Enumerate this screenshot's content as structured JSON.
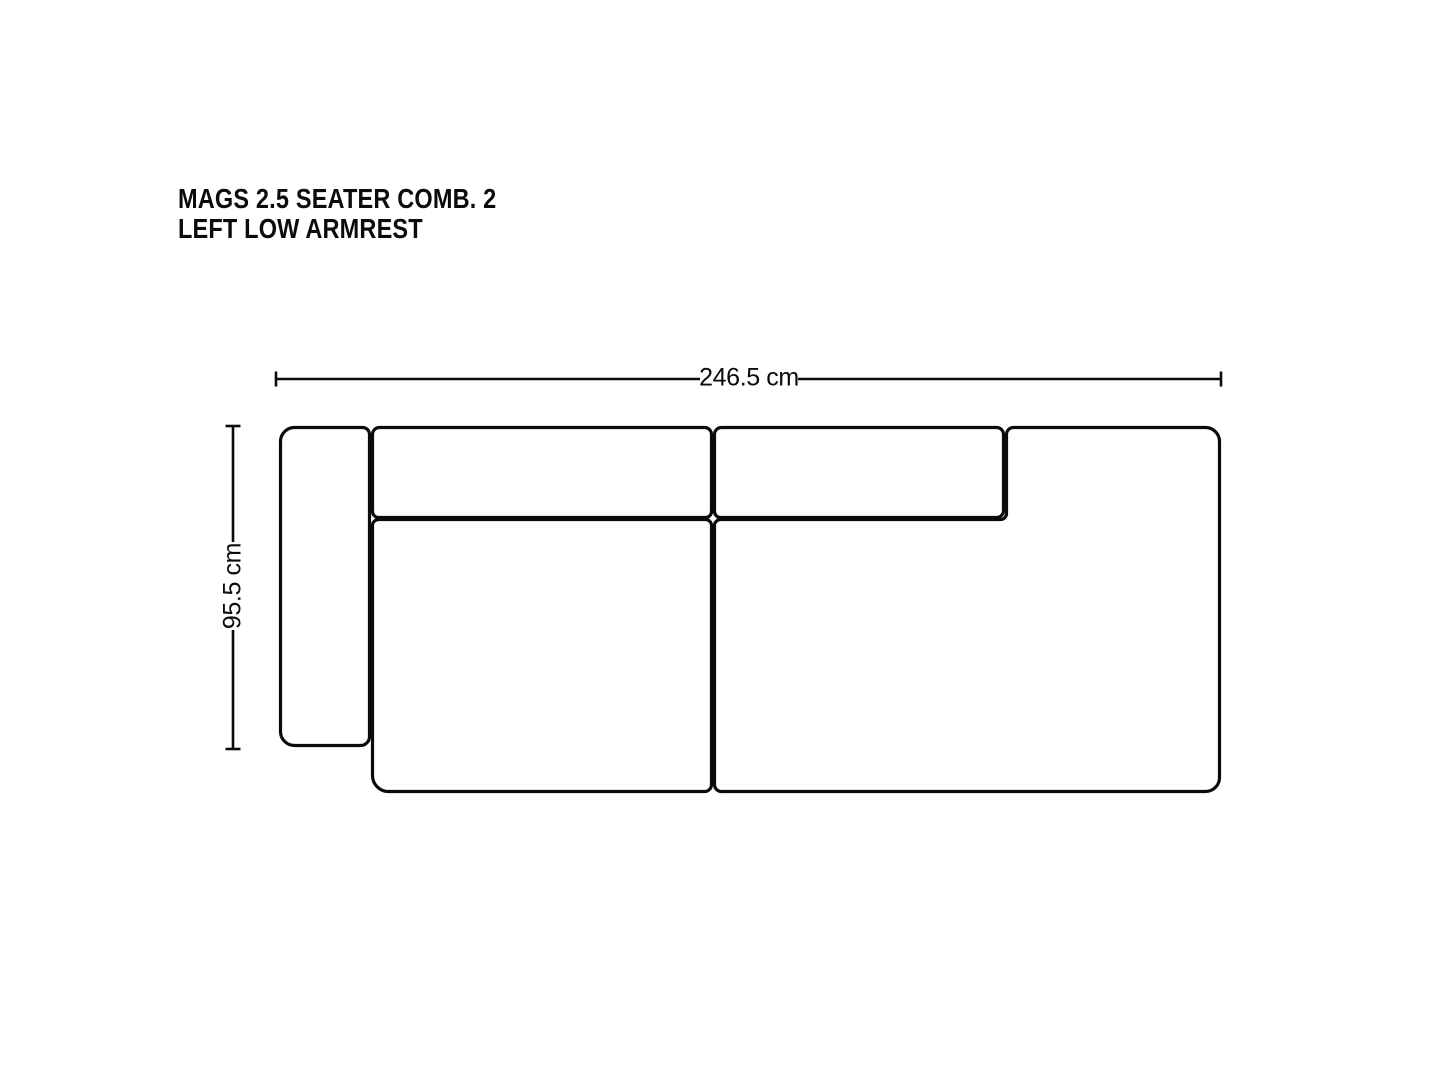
{
  "title": {
    "line1": "MAGS 2.5 SEATER COMB. 2",
    "line2": "LEFT LOW ARMREST"
  },
  "dimensions": {
    "width": "246.5 cm",
    "depth": "95.5 cm"
  },
  "colors": {
    "line": "#0b0b0b",
    "background": "#ffffff",
    "text": "#0b0b0b"
  }
}
